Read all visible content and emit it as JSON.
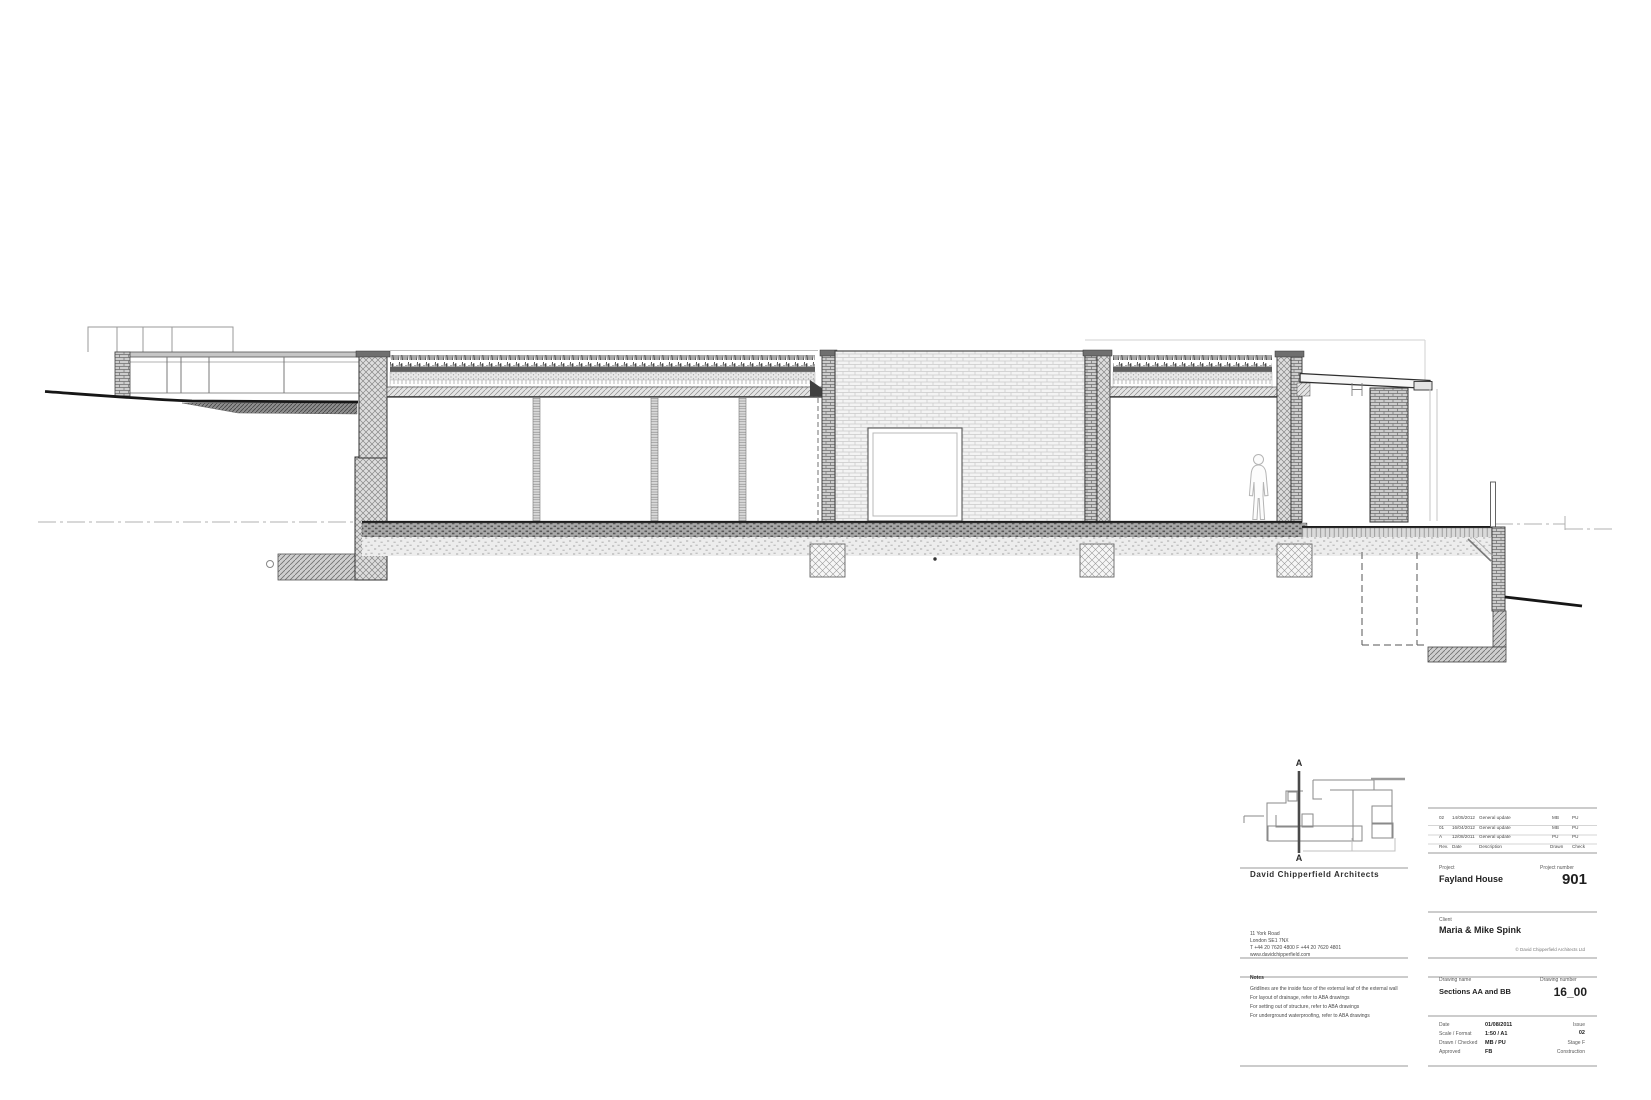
{
  "colors": {
    "paper": "#ffffff",
    "ink": "#1a1a1a",
    "line_gray": "#8a8a8a"
  },
  "section_drawing": {
    "marker_top": "A",
    "marker_bottom": "A"
  },
  "title_block": {
    "architect_name": "David Chipperfield Architects",
    "address": "11 York Road\nLondon SE1 7NX\nT +44 20 7620 4800    F +44 20 7620 4801\nwww.davidchipperfield.com",
    "notes_title": "Notes",
    "notes": "Gridlines are the inside face of the external leaf of the external wall\nFor layout of drainage, refer to ABA drawings\nFor setting out of structure, refer to ABA drawings\nFor underground waterproofing, refer to ABA drawings",
    "revisions": {
      "header": {
        "rev": "Rev.",
        "date": "Date",
        "description": "Description",
        "drawn": "Drawn",
        "check": "Check"
      },
      "rows": [
        {
          "rev": "02",
          "date": "14/05/2012",
          "description": "General update",
          "drawn": "MB",
          "check": "PU"
        },
        {
          "rev": "01",
          "date": "16/04/2012",
          "description": "General update",
          "drawn": "MB",
          "check": "PU"
        },
        {
          "rev": "A",
          "date": "12/08/2011",
          "description": "General update",
          "drawn": "PU",
          "check": "PU"
        }
      ]
    },
    "project": {
      "label": "Project",
      "value": "Fayland House"
    },
    "project_number": {
      "label": "Project number",
      "value": "901"
    },
    "client": {
      "label": "Client",
      "value": "Maria & Mike Spink"
    },
    "copyright": "© David Chipperfield Architects Ltd",
    "drawing_name": {
      "label": "Drawing name",
      "value": "Sections AA and BB"
    },
    "drawing_number": {
      "label": "Drawing number",
      "value": "16_00"
    },
    "issue_info": {
      "date_label": "Date",
      "date": "01/08/2011",
      "scale_label": "Scale / Format",
      "scale": "1:50 / A1",
      "drawn_label": "Drawn / Checked",
      "drawn": "MB / PU",
      "approved_label": "Approved",
      "approved": "FB",
      "issue_label": "Issue",
      "issue": "02",
      "stage": "Stage F",
      "status": "Construction"
    }
  }
}
